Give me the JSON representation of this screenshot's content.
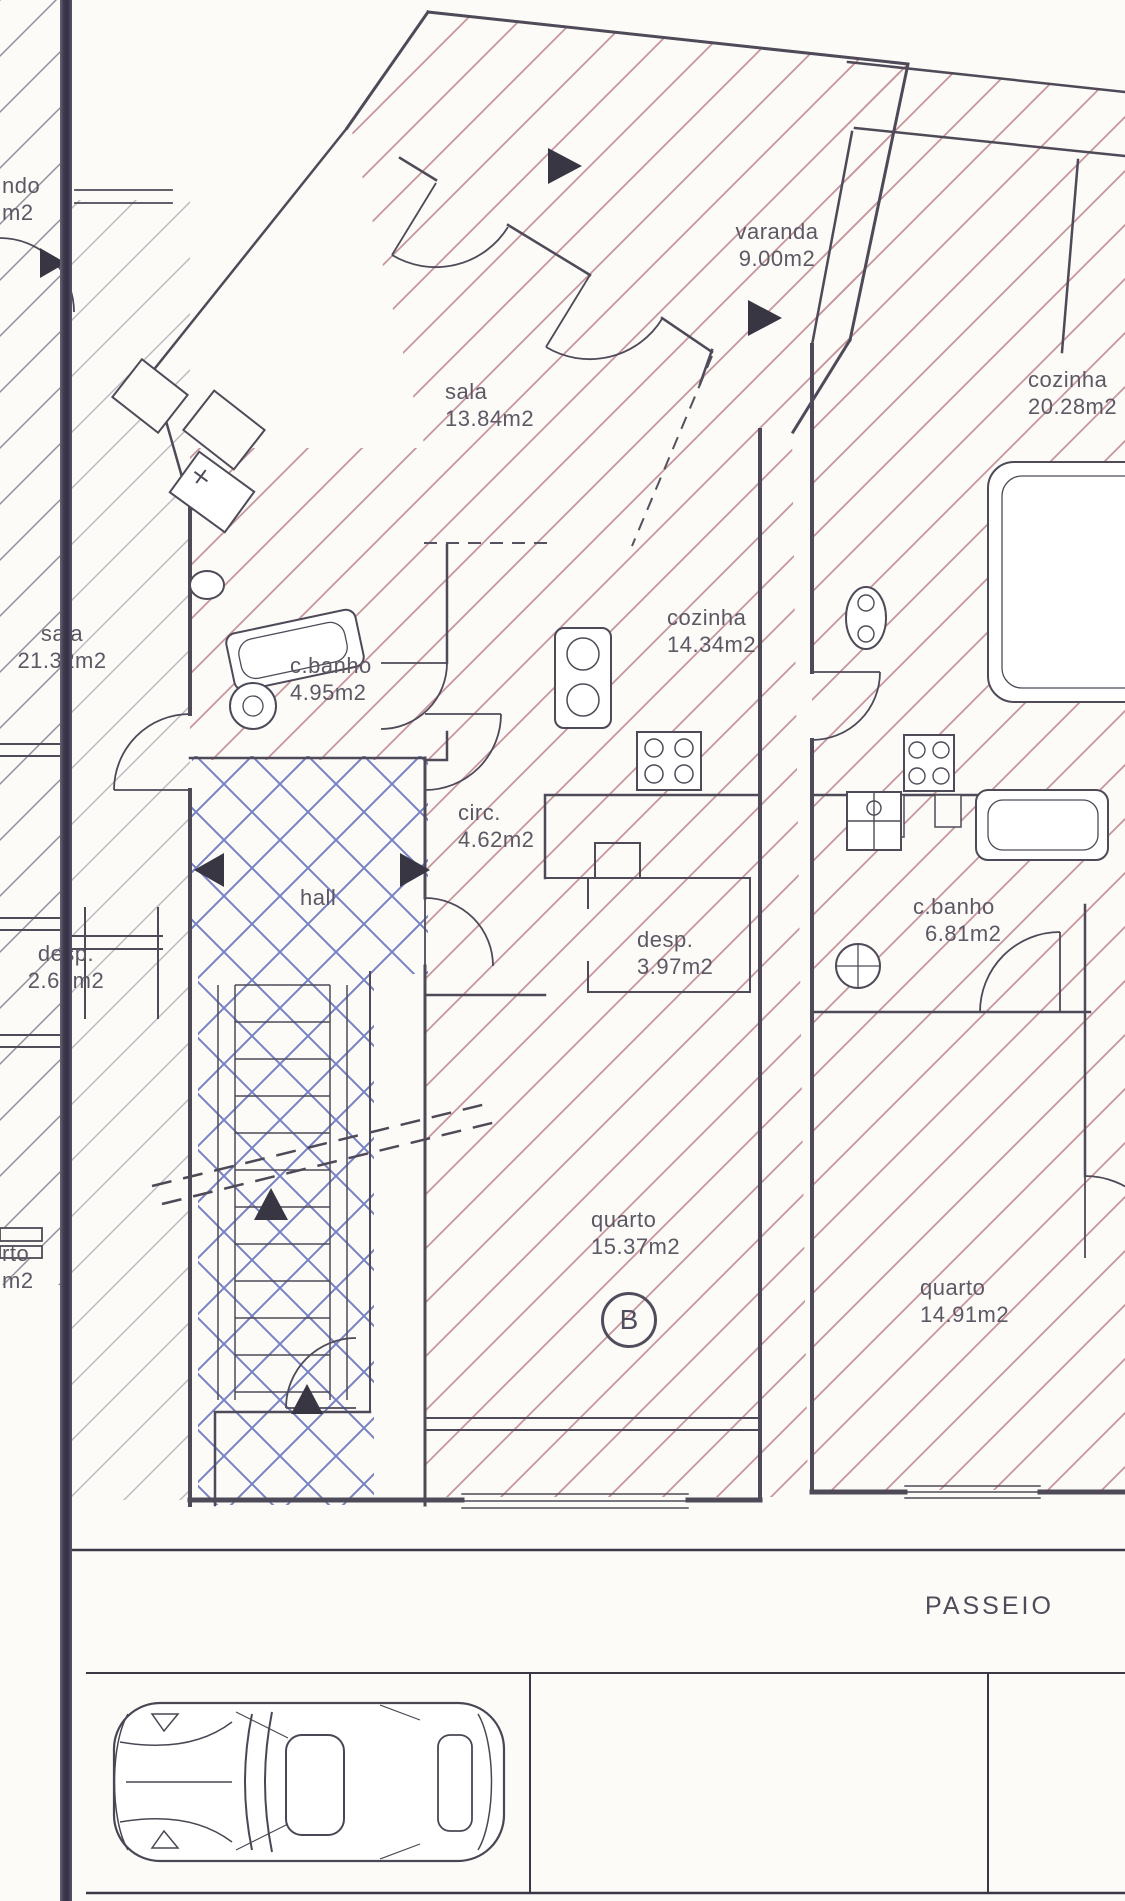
{
  "drawing": {
    "kind": "apartment floor plan (scanned architectural drawing)",
    "street_label": "PASSEIO",
    "unit_badge": "B"
  },
  "rooms": [
    {
      "name": "varanda",
      "area": "9.00m2"
    },
    {
      "name": "sala",
      "area": "13.84m2"
    },
    {
      "name": "cozinha",
      "area": "20.28m2"
    },
    {
      "name": "sala",
      "area": "21.32m2"
    },
    {
      "name": "c.banho",
      "area": "4.95m2"
    },
    {
      "name": "cozinha",
      "area": "14.34m2"
    },
    {
      "name": "circ.",
      "area": "4.62m2"
    },
    {
      "name": "hall",
      "area": ""
    },
    {
      "name": "desp.",
      "area": "2.65m2"
    },
    {
      "name": "desp.",
      "area": "3.97m2"
    },
    {
      "name": "c.banho",
      "area": "6.81m2"
    },
    {
      "name": "quarto",
      "area": "15.37m2"
    },
    {
      "name": "quarto",
      "area": "14.91m2"
    },
    {
      "name": "rto",
      "area": "m2"
    },
    {
      "name": "ndo",
      "area": "m2"
    }
  ],
  "colors": {
    "paper": "#fcfbf8",
    "wall_line": "#4e4a57",
    "hatch_pink": "#c6949c",
    "hatch_gray": "#90909b",
    "hatch_blue": "#7681c2",
    "fold_line": "#3f3a4e",
    "text": "#5c5864"
  }
}
